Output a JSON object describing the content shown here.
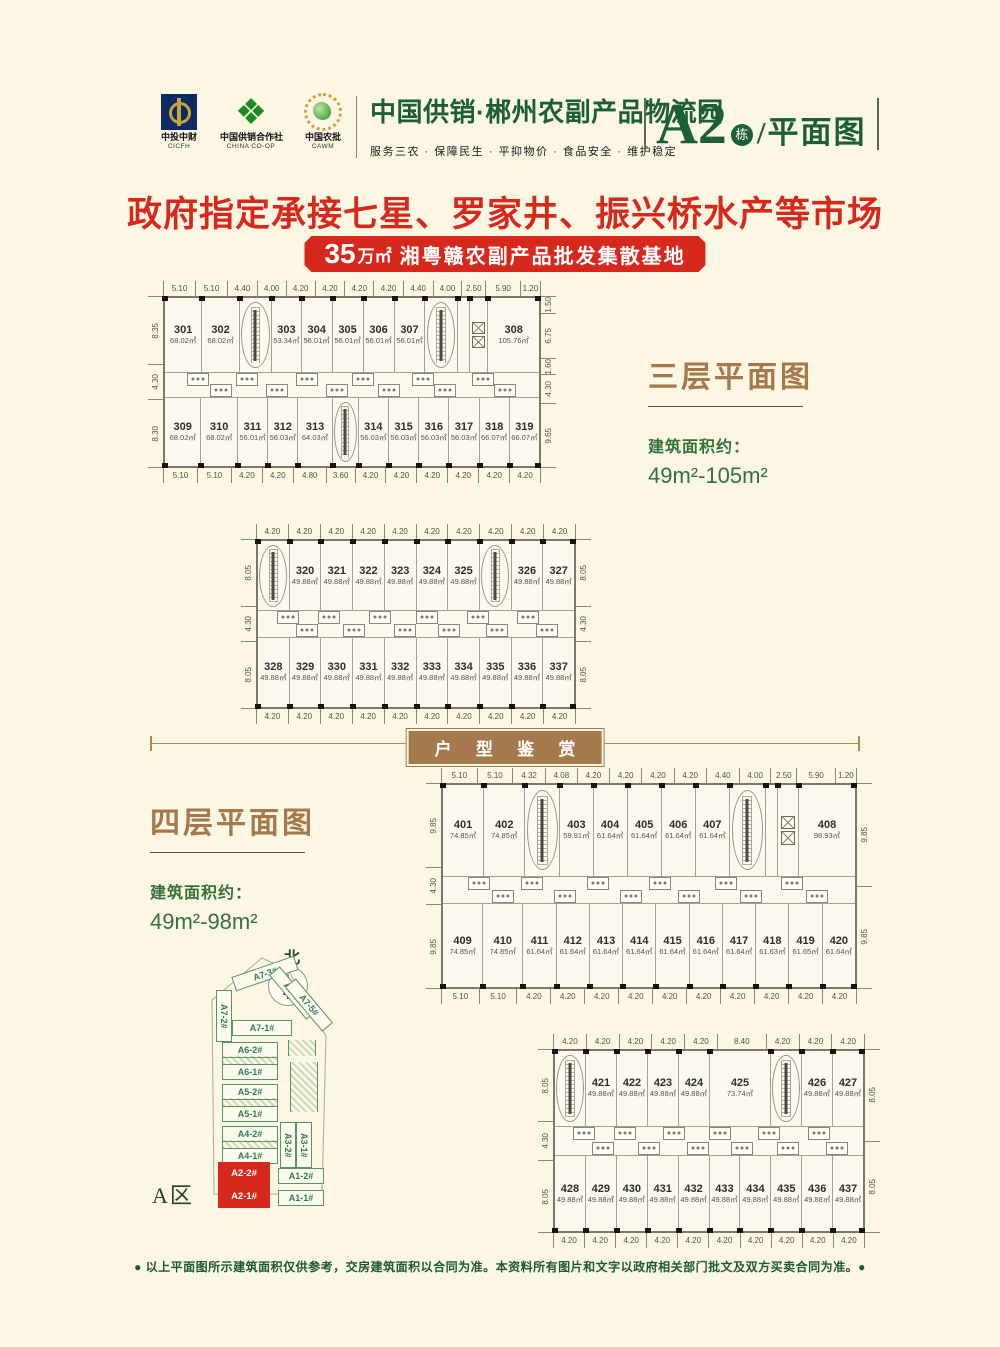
{
  "header": {
    "logos": [
      {
        "name": "cicfh-logo",
        "line1": "中投中财",
        "line2": "CICFH"
      },
      {
        "name": "china-coop-logo",
        "line1": "中国供销合作社",
        "line2": "CHINA CO-OP"
      },
      {
        "name": "cawm-logo",
        "line1": "中国农批",
        "line2": "CAWM"
      }
    ],
    "title": "中国供销·郴州农副产品物流园",
    "subtitle": "服务三农 · 保障民生 · 平抑物价 · 食品安全 · 维护稳定",
    "building": "A2",
    "building_suffix": "栋",
    "building_label": "/平面图"
  },
  "banner": {
    "headline": "政府指定承接七星、罗家井、振兴桥水产等市场",
    "badge_number": "35",
    "badge_unit": "万㎡",
    "badge_text": "湘粤赣农副产品批发集散基地",
    "red": "#d7281e"
  },
  "floor3": {
    "title": "三层平面图",
    "area_label": "建筑面积约：",
    "area_range": "49m²-105m²"
  },
  "floor4": {
    "title": "四层平面图",
    "area_label": "建筑面积约：",
    "area_range": "49m²-98m²"
  },
  "divider": {
    "label": "户 型 鉴 赏"
  },
  "floor_plans": {
    "planA": {
      "top_dims": [
        "5.10",
        "5.10",
        "4.40",
        "4.00",
        "4.20",
        "4.20",
        "4.20",
        "4.20",
        "4.40",
        "4.00",
        "2.50",
        "5.90",
        "1.20"
      ],
      "bottom_dims": [
        "5.10",
        "5.10",
        "4.20",
        "4.20",
        "4.80",
        "3.60",
        "4.20",
        "4.20",
        "4.20",
        "4.20",
        "4.20",
        "4.20"
      ],
      "left_dims": [
        "8.35",
        "4.30",
        "8.30"
      ],
      "right_dims": [
        "1.50",
        "6.75",
        "1.60",
        "4.30",
        "9.65"
      ],
      "top_row": [
        {
          "num": "301",
          "area": "68.02㎡",
          "w": 5.1
        },
        {
          "num": "302",
          "area": "68.02㎡",
          "w": 5.1
        },
        {
          "type": "stairs",
          "w": 4.4
        },
        {
          "num": "303",
          "area": "53.34㎡",
          "w": 4.0
        },
        {
          "num": "304",
          "area": "56.01㎡",
          "w": 4.2
        },
        {
          "num": "305",
          "area": "56.01㎡",
          "w": 4.2
        },
        {
          "num": "306",
          "area": "56.01㎡",
          "w": 4.2
        },
        {
          "num": "307",
          "area": "56.01㎡",
          "w": 4.2
        },
        {
          "type": "stairs",
          "w": 4.4
        },
        {
          "type": "open",
          "w": 1.5
        },
        {
          "type": "lift",
          "w": 2.5
        },
        {
          "num": "308",
          "area": "105.76㎡",
          "w": 7.1
        }
      ],
      "bottom_row": [
        {
          "num": "309",
          "area": "68.02㎡",
          "w": 5.1
        },
        {
          "num": "310",
          "area": "68.02㎡",
          "w": 5.1
        },
        {
          "num": "311",
          "area": "56.01㎡",
          "w": 4.2
        },
        {
          "num": "312",
          "area": "56.03㎡",
          "w": 4.2
        },
        {
          "num": "313",
          "area": "64.03㎡",
          "w": 4.8
        },
        {
          "type": "stairs",
          "w": 3.6
        },
        {
          "num": "314",
          "area": "56.03㎡",
          "w": 4.2
        },
        {
          "num": "315",
          "area": "56.03㎡",
          "w": 4.2
        },
        {
          "num": "316",
          "area": "56.03㎡",
          "w": 4.2
        },
        {
          "num": "317",
          "area": "56.03㎡",
          "w": 4.2
        },
        {
          "num": "318",
          "area": "66.07㎡",
          "w": 4.2
        },
        {
          "num": "319",
          "area": "66.07㎡",
          "w": 4.2
        }
      ]
    },
    "planB": {
      "top_dims": [
        "4.20",
        "4.20",
        "4.20",
        "4.20",
        "4.20",
        "4.20",
        "4.20",
        "4.20",
        "4.20",
        "4.20"
      ],
      "bottom_dims": [
        "4.20",
        "4.20",
        "4.20",
        "4.20",
        "4.20",
        "4.20",
        "4.20",
        "4.20",
        "4.20",
        "4.20"
      ],
      "left_dims": [
        "8.05",
        "4.30",
        "8.05"
      ],
      "right_dims": [
        "8.05",
        "4.30",
        "8.05"
      ],
      "top_row": [
        {
          "type": "stairs",
          "w": 4.2
        },
        {
          "num": "320",
          "area": "49.88㎡",
          "w": 4.2
        },
        {
          "num": "321",
          "area": "49.88㎡",
          "w": 4.2
        },
        {
          "num": "322",
          "area": "49.88㎡",
          "w": 4.2
        },
        {
          "num": "323",
          "area": "49.88㎡",
          "w": 4.2
        },
        {
          "num": "324",
          "area": "49.88㎡",
          "w": 4.2
        },
        {
          "num": "325",
          "area": "49.88㎡",
          "w": 4.2
        },
        {
          "type": "stairs",
          "w": 4.2
        },
        {
          "num": "326",
          "area": "49.88㎡",
          "w": 4.2
        },
        {
          "num": "327",
          "area": "49.88㎡",
          "w": 4.2
        }
      ],
      "bottom_row": [
        {
          "num": "328",
          "area": "49.88㎡",
          "w": 4.2
        },
        {
          "num": "329",
          "area": "49.88㎡",
          "w": 4.2
        },
        {
          "num": "330",
          "area": "49.88㎡",
          "w": 4.2
        },
        {
          "num": "331",
          "area": "49.88㎡",
          "w": 4.2
        },
        {
          "num": "332",
          "area": "49.88㎡",
          "w": 4.2
        },
        {
          "num": "333",
          "area": "49.88㎡",
          "w": 4.2
        },
        {
          "num": "334",
          "area": "49.88㎡",
          "w": 4.2
        },
        {
          "num": "335",
          "area": "49.88㎡",
          "w": 4.2
        },
        {
          "num": "336",
          "area": "49.88㎡",
          "w": 4.2
        },
        {
          "num": "337",
          "area": "49.88㎡",
          "w": 4.2
        }
      ]
    },
    "planC": {
      "top_dims": [
        "5.10",
        "5.10",
        "4.32",
        "4.08",
        "4.20",
        "4.20",
        "4.20",
        "4.20",
        "4.40",
        "4.00",
        "2.50",
        "5.90",
        "1.20"
      ],
      "bottom_dims": [
        "5.10",
        "5.10",
        "4.20",
        "4.20",
        "4.20",
        "4.20",
        "4.20",
        "4.20",
        "4.20",
        "4.20",
        "4.20",
        "4.20"
      ],
      "left_dims": [
        "9.85",
        "4.30",
        "9.85"
      ],
      "right_dims": [
        "9.85",
        "9.85"
      ],
      "top_row": [
        {
          "num": "401",
          "area": "74.85㎡",
          "w": 5.1
        },
        {
          "num": "402",
          "area": "74.85㎡",
          "w": 5.1
        },
        {
          "type": "stairs",
          "w": 4.32
        },
        {
          "num": "403",
          "area": "59.91㎡",
          "w": 4.08
        },
        {
          "num": "404",
          "area": "61.64㎡",
          "w": 4.2
        },
        {
          "num": "405",
          "area": "61.64㎡",
          "w": 4.2
        },
        {
          "num": "406",
          "area": "61.64㎡",
          "w": 4.2
        },
        {
          "num": "407",
          "area": "61.64㎡",
          "w": 4.2
        },
        {
          "type": "stairs",
          "w": 4.4
        },
        {
          "type": "open",
          "w": 1.5
        },
        {
          "type": "lift",
          "w": 2.5
        },
        {
          "num": "408",
          "area": "98.93㎡",
          "w": 7.1
        }
      ],
      "bottom_row": [
        {
          "num": "409",
          "area": "74.85㎡",
          "w": 5.1
        },
        {
          "num": "410",
          "area": "74.85㎡",
          "w": 5.1
        },
        {
          "num": "411",
          "area": "61.64㎡",
          "w": 4.2
        },
        {
          "num": "412",
          "area": "61.64㎡",
          "w": 4.2
        },
        {
          "num": "413",
          "area": "61.64㎡",
          "w": 4.2
        },
        {
          "num": "414",
          "area": "61.64㎡",
          "w": 4.2
        },
        {
          "num": "415",
          "area": "61.64㎡",
          "w": 4.2
        },
        {
          "num": "416",
          "area": "61.64㎡",
          "w": 4.2
        },
        {
          "num": "417",
          "area": "61.64㎡",
          "w": 4.2
        },
        {
          "num": "418",
          "area": "61.63㎡",
          "w": 4.2
        },
        {
          "num": "419",
          "area": "61.65㎡",
          "w": 4.2
        },
        {
          "num": "420",
          "area": "61.64㎡",
          "w": 4.2
        }
      ]
    },
    "planD": {
      "top_dims": [
        "4.20",
        "4.20",
        "4.20",
        "4.20",
        "4.20",
        "8.40",
        "4.20",
        "4.20",
        "4.20"
      ],
      "bottom_dims": [
        "4.20",
        "4.20",
        "4.20",
        "4.20",
        "4.20",
        "4.20",
        "4.20",
        "4.20",
        "4.20",
        "4.20"
      ],
      "left_dims": [
        "8.05",
        "4.30",
        "8.05"
      ],
      "right_dims": [
        "8.05",
        "8.05"
      ],
      "top_row": [
        {
          "type": "stairs",
          "w": 4.2
        },
        {
          "num": "421",
          "area": "49.88㎡",
          "w": 4.2
        },
        {
          "num": "422",
          "area": "49.88㎡",
          "w": 4.2
        },
        {
          "num": "423",
          "area": "49.88㎡",
          "w": 4.2
        },
        {
          "num": "424",
          "area": "49.88㎡",
          "w": 4.2
        },
        {
          "num": "425",
          "area": "73.74㎡",
          "w": 8.4
        },
        {
          "type": "stairs",
          "w": 4.2
        },
        {
          "num": "426",
          "area": "49.88㎡",
          "w": 4.2
        },
        {
          "num": "427",
          "area": "49.88㎡",
          "w": 4.2
        }
      ],
      "bottom_row": [
        {
          "num": "428",
          "area": "49.88㎡",
          "w": 4.2
        },
        {
          "num": "429",
          "area": "49.88㎡",
          "w": 4.2
        },
        {
          "num": "430",
          "area": "49.88㎡",
          "w": 4.2
        },
        {
          "num": "431",
          "area": "49.88㎡",
          "w": 4.2
        },
        {
          "num": "432",
          "area": "49.88㎡",
          "w": 4.2
        },
        {
          "num": "433",
          "area": "49.88㎡",
          "w": 4.2
        },
        {
          "num": "434",
          "area": "49.88㎡",
          "w": 4.2
        },
        {
          "num": "435",
          "area": "49.88㎡",
          "w": 4.2
        },
        {
          "num": "436",
          "area": "49.88㎡",
          "w": 4.2
        },
        {
          "num": "437",
          "area": "49.88㎡",
          "w": 4.2
        }
      ]
    }
  },
  "sitemap": {
    "north": "北",
    "zone": "A区",
    "buildings": [
      {
        "label": "A7-3#"
      },
      {
        "label": "A7-2#"
      },
      {
        "label": "A7-4#"
      },
      {
        "label": "A7-5#"
      },
      {
        "label": "A7-1#"
      },
      {
        "label": "A6-2#"
      },
      {
        "label": "A6-1#"
      },
      {
        "label": "A5-2#"
      },
      {
        "label": "A5-1#"
      },
      {
        "label": "A4-2#"
      },
      {
        "label": "A4-1#"
      },
      {
        "label": "A3-2#"
      },
      {
        "label": "A3-1#"
      },
      {
        "label": "A2-2#"
      },
      {
        "label": "A2-1#"
      },
      {
        "label": "A1-2#"
      },
      {
        "label": "A1-1#"
      }
    ],
    "highlight": "#d7281e"
  },
  "footer": {
    "disclaimer": "● 以上平面图所示建筑面积仅供参考，交房建筑面积以合同为准。本资料所有图片和文字以政府相关部门批文及双方买卖合同为准。●"
  }
}
